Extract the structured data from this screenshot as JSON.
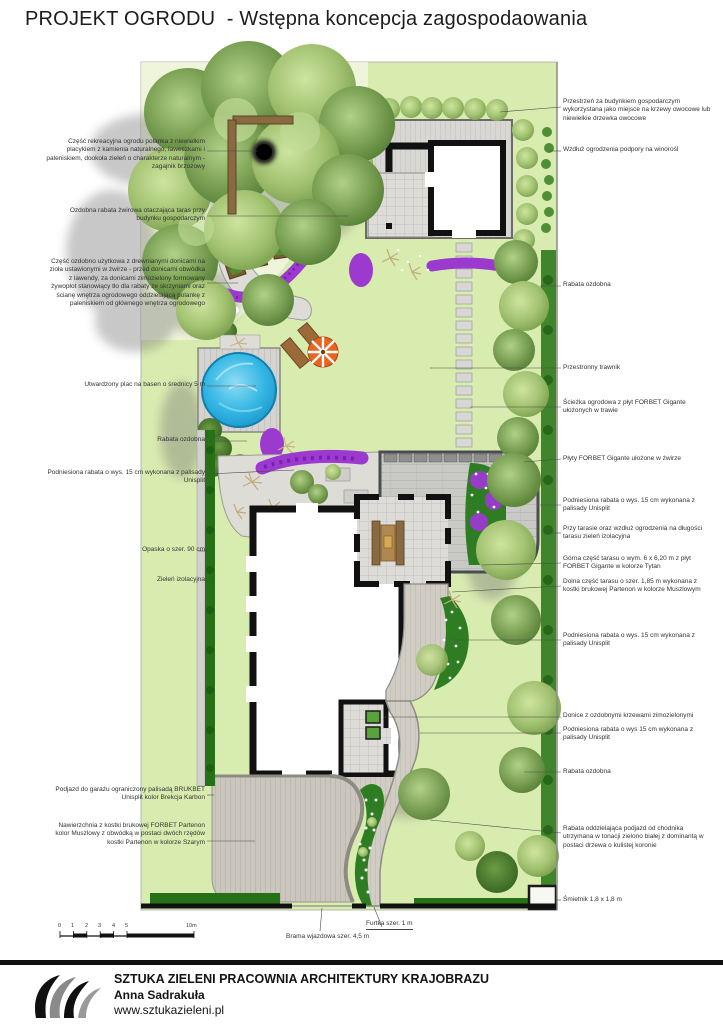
{
  "title": "PROJEKT OGRODU  - Wstępna koncepcja zagospodaowania",
  "annotations": {
    "left": [
      {
        "text": "Część rekreacyjna ogrodu polanka z niewielkim placykiem z kamienia naturalnego, ławeczkami i paleniskiem, dookoła zieleń o charakterze naturalnym - zagajnik brzozowy"
      },
      {
        "text": "Ozdobna rabata żwirowa otaczająca taras przy budynku gospodarczym"
      },
      {
        "text": "Część ozdobno użytkowa z drewnianymi donicami na zioła ustawionymi w żwirze - przed donicami obwódka z lawendy, za donicami zimozielony formowany żywopłot stanowiący tło dla rabaty ze skrzyniami oraz ścianę wnętrza ogrodowego oddzielającą polankę z paleniskiem od głównego wnętrza ogrodowego"
      },
      {
        "text": "Utwardzony plac na basen o średnicy 5 m"
      },
      {
        "text": "Rabata ozdobna"
      },
      {
        "text": "Podniesiona rabata o wys. 15 cm wykonana z palisady Unisplit"
      },
      {
        "text": "Opaska o szer. 90 cm"
      },
      {
        "text": "Zieleń izolacyjna"
      },
      {
        "text": "Podjazd do garażu ograniczony palisadą  BRUKBET Unisplit  kolor Brekcja Karbon"
      },
      {
        "text": "Nawierzchnia z kostki brukowej FORBET Partenon kolor Muszlowy z obwódką w postaci dwóch rzędów kostki Partenon w kolorze Szarym"
      }
    ],
    "right": [
      {
        "text": "Przestrzeń za budynkiem gospodarczym wykorzystana jako miejsce na krzewy owocowe lub niewielkie drzewka owocowe"
      },
      {
        "text": "Wzdłuż ogrodzenia podpory na winorośl"
      },
      {
        "text": "Rabata ozdobna"
      },
      {
        "text": "Przestronny trawnik"
      },
      {
        "text": "Ścieżka ogrodowa z płyt FORBET Gigante ułożonych w trawie"
      },
      {
        "text": "Płyty FORBET Gigante ułożone w żwirze"
      },
      {
        "text": "Podniesiona rabata o wys. 15 cm wykonana z palisady Unisplit"
      },
      {
        "text": "Przy tarasie oraz wzdłuż ogrodzenia na długości tarasu zieleń izolacyjna"
      },
      {
        "text": "Górna część tarasu o wym. 6 x 6,20 m z płyt FORBET Gigante w kolorze Tytan"
      },
      {
        "text": "Dolna część tarasu o szer. 1,85 m wykonana z kostki brukowej Partenon w kolorze Muszlowym"
      },
      {
        "text": "Podniesiona rabata o wys. 15 cm wykonana z palisady Unisplit"
      },
      {
        "text": "Donice z ozdobnymi krzewami zimozielonymi"
      },
      {
        "text": "Podniesiona rabata o wys 15 cm wykonana z palisady Unisplit"
      },
      {
        "text": "Rabata ozdobna"
      },
      {
        "text": "Rabata oddzielająca podjazd od chodnika utrzymana w tonacji zielono białej z dominantą w postaci drzewa o kulistej koronie"
      },
      {
        "text": "Śmietnik 1,8 x 1,8 m"
      }
    ],
    "bottom": [
      {
        "text": "Brama wjazdowa szer. 4,5 m"
      },
      {
        "text": "Furtka szer. 1 m"
      }
    ]
  },
  "scale_bar": {
    "ticks": [
      "0",
      "1",
      "2",
      "3",
      "4",
      "5"
    ],
    "end_label": "10m"
  },
  "footer": {
    "studio": "SZTUKA ZIELENI PRACOWNIA ARCHITEKTURY KRAJOBRAZU",
    "author": "Anna Sadrakuła",
    "website": "www.sztukazieleni.pl"
  },
  "plan": {
    "colors": {
      "lawn": "#d9ecb0",
      "tree": "#6f9a48",
      "tree_light": "#a9cc72",
      "hedge": "#267116",
      "pool": "#29b3e4",
      "paving": "#cdccc8",
      "driveway": "#cbc7be",
      "flower_purple": "#9c3ad0",
      "umbrella": "#e8641f",
      "wall": "#111111"
    }
  }
}
